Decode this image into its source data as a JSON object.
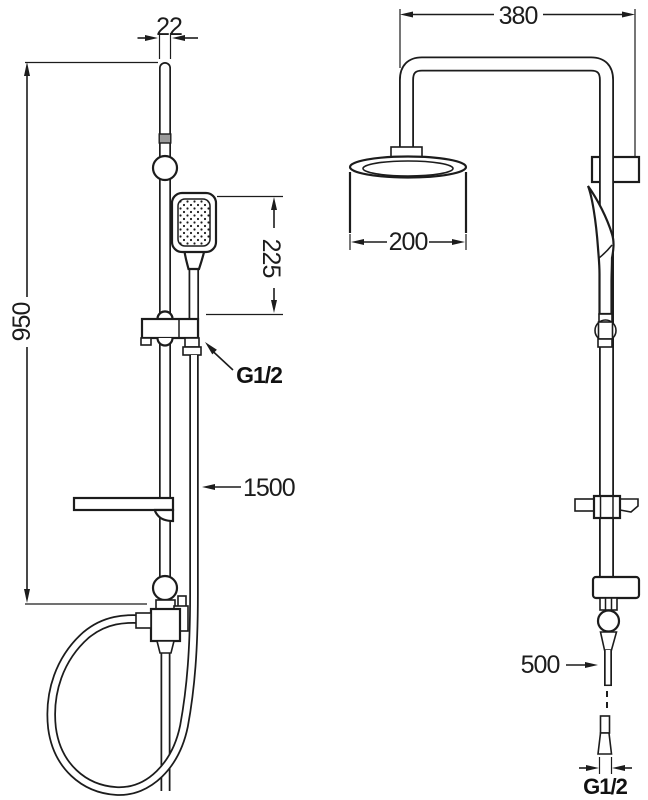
{
  "drawing": {
    "front_view": {
      "rail_width": "22",
      "total_height": "950",
      "handset_length": "225",
      "handset_connection": "G1/2",
      "hose_length": "1500"
    },
    "side_view": {
      "arm_reach": "380",
      "head_diameter": "200",
      "inlet_pipe_length": "500",
      "inlet_connection": "G1/2"
    },
    "colors": {
      "line": "#1c1c1c",
      "band": "#9a9a9a",
      "background": "#ffffff"
    }
  }
}
